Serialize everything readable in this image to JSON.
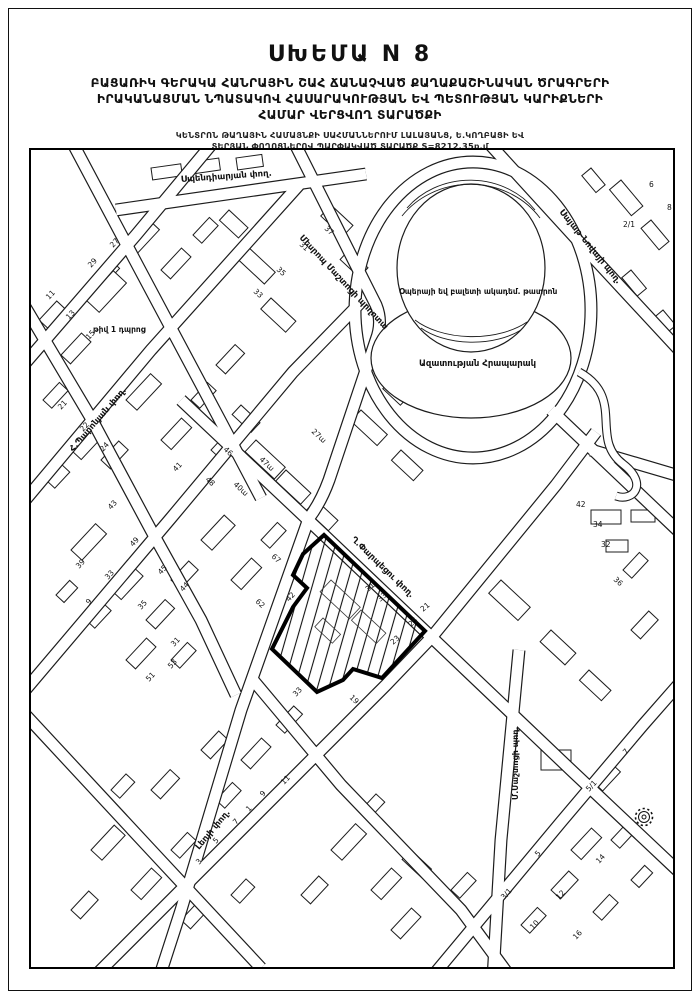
{
  "header": {
    "title": "ՍԽԵՄԱ N 8",
    "subtitle_line1": "ԲԱՑԱՌԻԿ ԳԵՐԱԿԱ ՀԱՆՐԱՅԻՆ ՇԱՀ ՃԱՆԱՉՎԱԾ ՔԱՂԱՔԱՇԻՆԱԿԱՆ ԾՐԱԳՐԵՐԻ",
    "subtitle_line2": "ԻՐԱԿԱՆԱՑՄԱՆ ՆՊԱՏԱԿՈՎ ՀԱՍԱՐԱԿՈՒԹՅԱՆ ԵՎ ՊԵՏՈՒԹՅԱՆ ԿԱՐԻՔՆԵՐԻ",
    "subtitle_line3": "ՀԱՄԱՐ ՎԵՐՑՎՈՂ ՏԱՐԱԾՔԻ",
    "note_line1": "ԿԵՆՏՐՈՆ ԹԱՂԱՅԻՆ ՀԱՄԱՅՆՔԻ ՍԱՀՄԱՆՆԵՐՈՒՄ ԼԱԼԱՅԱՆՑ, Ե.ԿՈՂԲԱՑԻ ԵՎ",
    "note_line2": "ՏԵՐՅԱՆ ՓՈՂՈՑՆԵՐՈՎ ՊԱՐՓԱԿՎԱԾ ՏԱՐԱԾՔ S=8212,35ք.մ"
  },
  "map": {
    "area_value": "S=8212,35ք.մ",
    "street_labels": [
      {
        "t": "Սպենդիարյան փող.",
        "x": 150,
        "y": 32,
        "r": -4,
        "s": 8.5
      },
      {
        "t": "Մեսրոպ Մաշտոցի պողոտա",
        "x": 268,
        "y": 88,
        "r": 47,
        "s": 8.5
      },
      {
        "t": "Սայաթ-Նովայի պող.",
        "x": 528,
        "y": 62,
        "r": 51,
        "s": 8.5
      },
      {
        "t": "Ղ.Փարպեցու փող.",
        "x": 320,
        "y": 390,
        "r": 44,
        "s": 8.5
      },
      {
        "t": "Հ.Պարոնյան փող.",
        "x": 42,
        "y": 302,
        "r": -49,
        "s": 8.5
      },
      {
        "t": "Լեոյի փող.",
        "x": 168,
        "y": 700,
        "r": -50,
        "s": 8.5
      },
      {
        "t": "Մ.Մաշտոցի պող.",
        "x": 487,
        "y": 650,
        "r": -90,
        "s": 8
      },
      {
        "t": "թիվ 1 դպրոց",
        "x": 62,
        "y": 182,
        "r": 0,
        "s": 7.5
      },
      {
        "t": "Օպերայի եվ բալետի ակադեմ. թատրոն",
        "x": 368,
        "y": 144,
        "r": 0,
        "s": 7.5
      },
      {
        "t": "Ազատության Հրապարակ",
        "x": 388,
        "y": 216,
        "r": 0,
        "s": 8.5
      }
    ],
    "building_numbers": [
      [
        "31",
        268,
        95,
        43
      ],
      [
        "37",
        293,
        79,
        43
      ],
      [
        "35",
        245,
        120,
        43
      ],
      [
        "33",
        222,
        142,
        43
      ],
      [
        "29",
        60,
        118,
        -47
      ],
      [
        "27",
        82,
        98,
        -47
      ],
      [
        "11",
        18,
        150,
        -47
      ],
      [
        "13",
        38,
        170,
        -47
      ],
      [
        "15",
        58,
        190,
        -47
      ],
      [
        "21",
        30,
        260,
        -47
      ],
      [
        "22",
        52,
        282,
        -47
      ],
      [
        "24",
        72,
        302,
        -47
      ],
      [
        "39",
        48,
        419,
        -47
      ],
      [
        "49",
        102,
        397,
        -47
      ],
      [
        "45",
        130,
        425,
        -47
      ],
      [
        "44",
        152,
        442,
        -47
      ],
      [
        "33",
        77,
        430,
        -47
      ],
      [
        "35",
        110,
        460,
        -47
      ],
      [
        "31",
        143,
        497,
        -47
      ],
      [
        "9",
        58,
        455,
        -47
      ],
      [
        "51",
        118,
        532,
        -47
      ],
      [
        "53",
        140,
        519,
        -47
      ],
      [
        "41",
        145,
        322,
        -47
      ],
      [
        "43",
        80,
        360,
        -47
      ],
      [
        "47ա",
        228,
        310,
        43
      ],
      [
        "40ա",
        202,
        335,
        43
      ],
      [
        "67",
        240,
        407,
        43
      ],
      [
        "62",
        224,
        452,
        43
      ],
      [
        "42",
        258,
        452,
        -47
      ],
      [
        "46",
        192,
        300,
        43
      ],
      [
        "48",
        174,
        330,
        43
      ],
      [
        "27ա",
        280,
        282,
        43
      ],
      [
        "2/1",
        592,
        77,
        0
      ],
      [
        "6",
        618,
        37,
        0
      ],
      [
        "8",
        636,
        60,
        0
      ],
      [
        "42",
        545,
        357,
        0
      ],
      [
        "34",
        562,
        377,
        0
      ],
      [
        "32",
        570,
        397,
        0
      ],
      [
        "36",
        582,
        430,
        43
      ],
      [
        "31",
        337,
        442,
        -40
      ],
      [
        "33",
        349,
        452,
        -40
      ],
      [
        "25",
        380,
        477,
        -40
      ],
      [
        "23",
        362,
        495,
        -40
      ],
      [
        "21",
        392,
        462,
        -40
      ],
      [
        "19",
        318,
        548,
        43
      ],
      [
        "33",
        265,
        547,
        -47
      ],
      [
        "9",
        232,
        647,
        -47
      ],
      [
        "7",
        205,
        675,
        -47
      ],
      [
        "5",
        185,
        694,
        -47
      ],
      [
        "3",
        168,
        715,
        -47
      ],
      [
        "11",
        253,
        635,
        -47
      ],
      [
        "1",
        218,
        662,
        -47
      ],
      [
        "7",
        595,
        605,
        -47
      ],
      [
        "5/1",
        558,
        642,
        -47
      ],
      [
        "14",
        568,
        714,
        -47
      ],
      [
        "12",
        528,
        750,
        -47
      ],
      [
        "10",
        502,
        780,
        -47
      ],
      [
        "3/1",
        473,
        750,
        -47
      ],
      [
        "5",
        507,
        707,
        -47
      ],
      [
        "16",
        545,
        790,
        -47
      ]
    ],
    "buildings": [
      [
        215,
        95,
        40,
        16,
        43
      ],
      [
        240,
        148,
        34,
        15,
        43
      ],
      [
        198,
        60,
        26,
        14,
        43
      ],
      [
        300,
        55,
        30,
        15,
        43
      ],
      [
        318,
        100,
        26,
        13,
        43
      ],
      [
        120,
        18,
        30,
        12,
        -8
      ],
      [
        160,
        12,
        28,
        12,
        -8
      ],
      [
        205,
        8,
        26,
        12,
        -8
      ],
      [
        95,
        95,
        34,
        14,
        -47
      ],
      [
        130,
        120,
        30,
        13,
        -47
      ],
      [
        60,
        130,
        28,
        13,
        -47
      ],
      [
        162,
        85,
        24,
        12,
        -47
      ],
      [
        8,
        170,
        26,
        12,
        -47
      ],
      [
        30,
        205,
        30,
        13,
        -47
      ],
      [
        12,
        250,
        24,
        12,
        -47
      ],
      [
        40,
        300,
        34,
        14,
        -47
      ],
      [
        15,
        330,
        22,
        12,
        -47
      ],
      [
        95,
        250,
        36,
        15,
        -47
      ],
      [
        130,
        290,
        30,
        14,
        -47
      ],
      [
        70,
        310,
        26,
        13,
        -47
      ],
      [
        160,
        250,
        24,
        12,
        -47
      ],
      [
        185,
        215,
        28,
        13,
        -47
      ],
      [
        55,
        150,
        40,
        18,
        -47
      ],
      [
        170,
        390,
        34,
        15,
        -47
      ],
      [
        200,
        430,
        30,
        14,
        -47
      ],
      [
        140,
        430,
        26,
        13,
        -47
      ],
      [
        230,
        390,
        24,
        12,
        -47
      ],
      [
        40,
        400,
        36,
        15,
        -47
      ],
      [
        80,
        440,
        32,
        14,
        -47
      ],
      [
        115,
        470,
        28,
        13,
        -47
      ],
      [
        55,
        470,
        24,
        12,
        -47
      ],
      [
        95,
        510,
        30,
        13,
        -47
      ],
      [
        140,
        510,
        24,
        12,
        -47
      ],
      [
        25,
        445,
        20,
        11,
        -47
      ],
      [
        60,
        700,
        34,
        15,
        -47
      ],
      [
        100,
        740,
        30,
        14,
        -47
      ],
      [
        40,
        760,
        26,
        13,
        -47
      ],
      [
        140,
        700,
        24,
        12,
        -47
      ],
      [
        120,
        640,
        28,
        13,
        -47
      ],
      [
        170,
        600,
        26,
        13,
        -47
      ],
      [
        80,
        640,
        22,
        12,
        -47
      ],
      [
        150,
        770,
        30,
        13,
        -47
      ],
      [
        200,
        745,
        22,
        12,
        -47
      ],
      [
        210,
        610,
        30,
        13,
        -47
      ],
      [
        245,
        575,
        26,
        12,
        -47
      ],
      [
        185,
        650,
        24,
        12,
        -47
      ],
      [
        300,
        700,
        36,
        15,
        -47
      ],
      [
        340,
        740,
        30,
        14,
        -47
      ],
      [
        270,
        745,
        26,
        13,
        -47
      ],
      [
        380,
        700,
        28,
        13,
        43
      ],
      [
        330,
        660,
        22,
        12,
        -47
      ],
      [
        360,
        780,
        30,
        13,
        -47
      ],
      [
        420,
        740,
        24,
        12,
        -47
      ],
      [
        510,
        600,
        30,
        20,
        0
      ],
      [
        560,
        630,
        26,
        16,
        -47
      ],
      [
        540,
        700,
        30,
        14,
        -47
      ],
      [
        580,
        690,
        22,
        12,
        -47
      ],
      [
        520,
        740,
        26,
        13,
        -47
      ],
      [
        562,
        762,
        24,
        12,
        -47
      ],
      [
        600,
        730,
        20,
        11,
        -47
      ],
      [
        490,
        775,
        24,
        12,
        -47
      ],
      [
        470,
        430,
        40,
        18,
        43
      ],
      [
        520,
        480,
        34,
        16,
        43
      ],
      [
        558,
        520,
        30,
        14,
        43
      ],
      [
        600,
        480,
        26,
        13,
        -47
      ],
      [
        592,
        420,
        24,
        12,
        -47
      ],
      [
        560,
        360,
        30,
        14,
        0
      ],
      [
        600,
        360,
        24,
        12,
        0
      ],
      [
        575,
        390,
        22,
        12,
        0
      ],
      [
        590,
        30,
        34,
        15,
        50
      ],
      [
        620,
        70,
        28,
        13,
        50
      ],
      [
        600,
        120,
        24,
        12,
        50
      ],
      [
        560,
        18,
        22,
        12,
        50
      ],
      [
        632,
        160,
        20,
        11,
        50
      ],
      [
        225,
        290,
        40,
        16,
        43
      ],
      [
        255,
        320,
        34,
        15,
        43
      ],
      [
        285,
        350,
        30,
        14,
        43
      ],
      [
        210,
        255,
        26,
        13,
        43
      ],
      [
        180,
        300,
        22,
        12,
        -47
      ],
      [
        330,
        260,
        36,
        15,
        43
      ],
      [
        370,
        300,
        30,
        14,
        43
      ],
      [
        360,
        230,
        24,
        12,
        43
      ],
      [
        390,
        85,
        22,
        18,
        0
      ],
      [
        478,
        90,
        22,
        16,
        0
      ],
      [
        402,
        185,
        9,
        9,
        0
      ],
      [
        462,
        190,
        9,
        9,
        0
      ]
    ],
    "parcel_inner": [
      [
        300,
        430,
        40,
        16,
        43
      ],
      [
        330,
        460,
        34,
        14,
        43
      ],
      [
        292,
        468,
        24,
        12,
        43
      ]
    ]
  }
}
